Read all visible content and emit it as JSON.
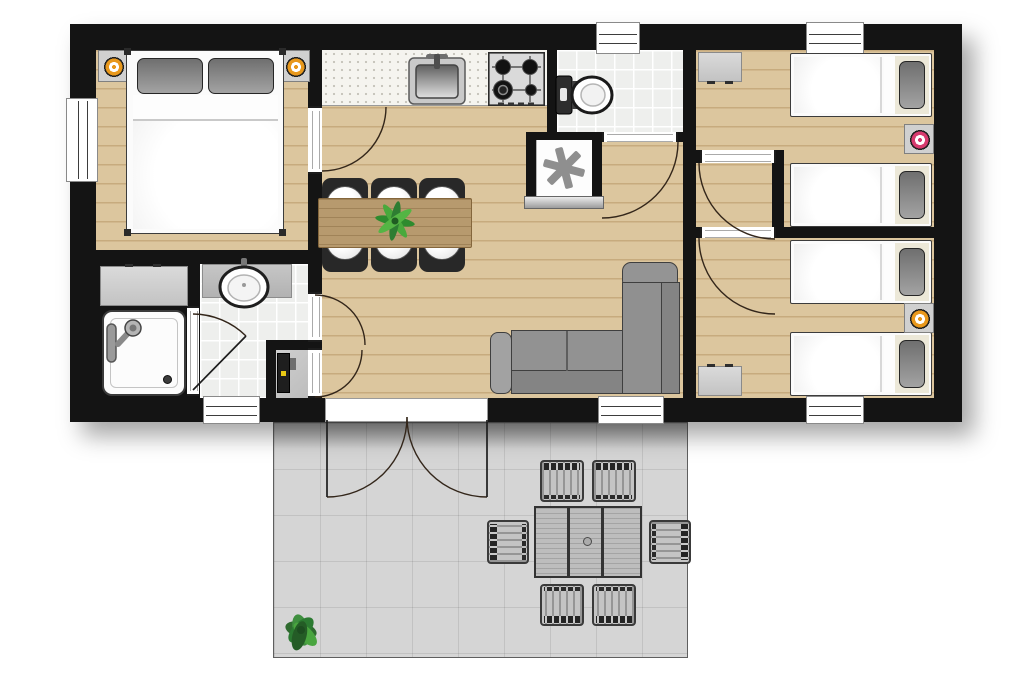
{
  "document": {
    "kind": "holiday-home floor plan, top-down 2D render",
    "visible_text": []
  },
  "palette": {
    "wall": "#141414",
    "wood_floor": "#dcc69e",
    "wood_plank_line": "#b99a68",
    "tile_floor": "#eeefed",
    "terrace_tiles": "#d5d5d5",
    "kitchen_counter": "#f5f4ef",
    "sofa_gray": "#909090",
    "dining_chair_frame": "#282828",
    "cushion_white": "#f4f4f4",
    "table_wood": "#b79a6e",
    "outdoor_furniture_gray": "#c4c4c4",
    "lamp_orange": "#e8981c",
    "lamp_pink": "#d63a6e",
    "plant_green": "#39942c",
    "bed_linen_white": "#fafafa",
    "pillow_gray": "#8a8a8a",
    "utility_marker_gray": "#8f8f8f"
  },
  "symbols": {
    "utility_marker": "✱"
  },
  "rooms": [
    {
      "id": "bedroom-master",
      "floor": "wood",
      "furniture": [
        "double-bed",
        "nightstand-left",
        "nightstand-right",
        "bedside-lamp-orange-left",
        "bedside-lamp-orange-right"
      ],
      "windows": [
        "left-wall"
      ]
    },
    {
      "id": "bathroom",
      "floor": "tile",
      "furniture": [
        "shower-tray",
        "hand-shower",
        "shower-door",
        "washbasin-on-counter",
        "storage-cabinet"
      ],
      "windows": [
        "bottom-wall"
      ]
    },
    {
      "id": "tech-closet",
      "floor": "stone",
      "furniture": [
        "meter-box"
      ]
    },
    {
      "id": "toilet",
      "floor": "tile",
      "furniture": [
        "toilet"
      ],
      "windows": [
        "top-wall"
      ]
    },
    {
      "id": "kitchen-living",
      "floor": "wood",
      "furniture": [
        "kitchen-counter",
        "kitchen-sink",
        "gas-hob-4-burners",
        "utility-unit-with-asterisk",
        "dining-table",
        "dining-chairs-x6",
        "table-plant",
        "corner-sofa"
      ],
      "windows": [
        "bottom-wall"
      ],
      "exits": [
        "french-doors-to-terrace"
      ]
    },
    {
      "id": "bedroom-right-top",
      "floor": "wood",
      "furniture": [
        "single-bed-x2",
        "bedside-lamp-pink",
        "cabinet"
      ],
      "windows": [
        "top-wall"
      ]
    },
    {
      "id": "bedroom-right-bottom",
      "floor": "wood",
      "furniture": [
        "single-bed-x2",
        "bedside-lamp-orange",
        "cabinet"
      ],
      "windows": [
        "bottom-wall"
      ]
    },
    {
      "id": "terrace",
      "floor": "concrete-tiles",
      "furniture": [
        "outdoor-dining-table",
        "outdoor-chairs-x6",
        "potted-plant"
      ]
    }
  ],
  "counts": {
    "interior_doors": 6,
    "exterior_french_doors": 1,
    "shower_door": 1,
    "windows": 6
  }
}
